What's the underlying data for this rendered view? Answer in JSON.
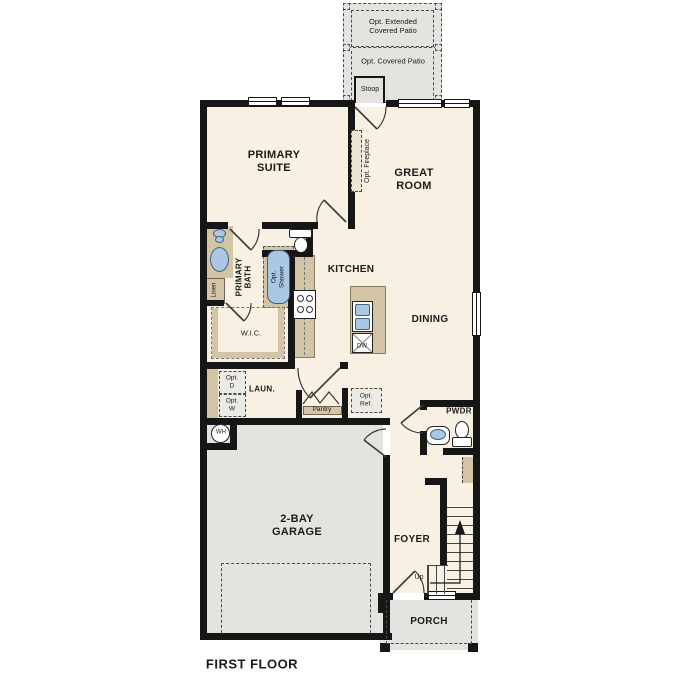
{
  "plan": {
    "title": "FIRST FLOOR"
  },
  "labels": {
    "patio_extended": "Opt. Extended\nCovered Patio",
    "patio_covered": "Opt. Covered Patio",
    "stoop": "Stoop",
    "primary_suite": "PRIMARY\nSUITE",
    "great_room": "GREAT\nROOM",
    "opt_fireplace": "Opt. Fireplace",
    "primary_bath": "PRIMARY\nBATH",
    "linen": "Linen",
    "opt_shower": "Opt.\nShower",
    "wic": "W.I.C.",
    "kitchen": "KITCHEN",
    "dining": "DINING",
    "laundry": "LAUN.",
    "opt_dryer": "Opt.\nD",
    "opt_washer": "Opt.\nW",
    "pantry": "Pantry",
    "opt_fridge": "Opt.\nRef.",
    "powder": "PWDR",
    "water_heater": "WH",
    "garage": "2-BAY\nGARAGE",
    "foyer": "FOYER",
    "up": "Up",
    "porch": "PORCH",
    "dishwasher": "DW"
  },
  "colors": {
    "floor": "#f8f0e2",
    "exterior": "#e4e3df",
    "wall": "#161616",
    "cabinet": "#d3c4a6",
    "fixture": "#aac7e3"
  }
}
